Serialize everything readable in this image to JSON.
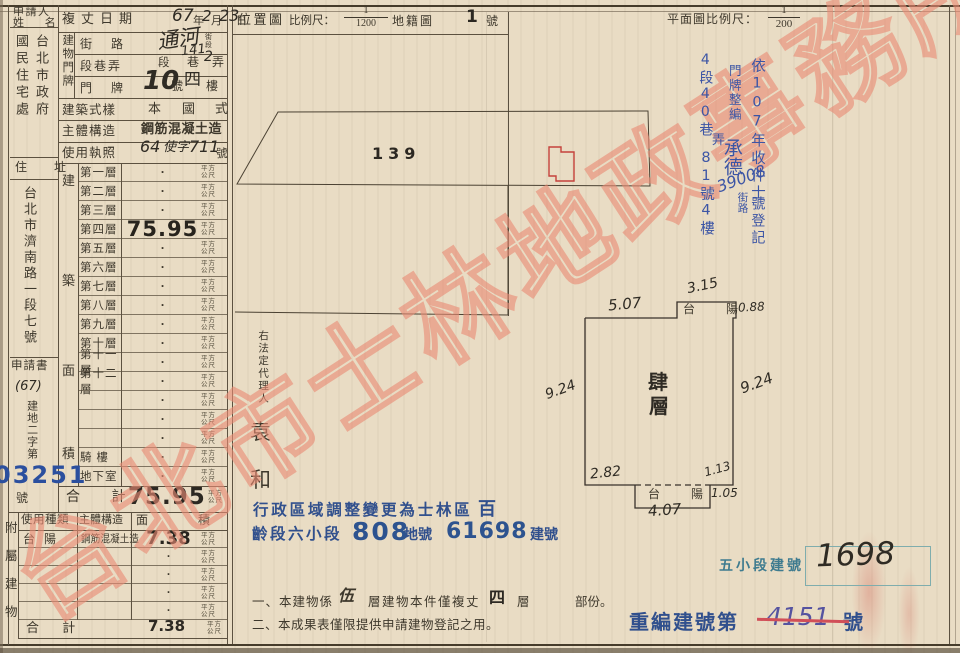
{
  "watermark": {
    "text": "台北市士林地政事務所"
  },
  "header": {
    "survey_label": "複丈日期",
    "survey_y": "67",
    "survey_y_u": "年",
    "survey_m": "2",
    "survey_m_u": "月",
    "survey_d": "23",
    "survey_d_u": "日"
  },
  "applicant": {
    "label1": "申請人",
    "label2": "姓 名",
    "org_right": "台北市政府",
    "org_left": "國民住宅處",
    "addr_label": "住 址",
    "address": "台北市濟南路一段七號",
    "doc_label": "申請書",
    "doc_year": "(67)",
    "doc_chars": "建地二字第",
    "doc_no": "03251",
    "doc_suffix": "號"
  },
  "plate": {
    "label": "建物門牌",
    "street_label": "街 路",
    "street_value": "通河",
    "street_tiny1": "街",
    "street_tiny2": "段",
    "sec_label": "段巷弄",
    "sec_t1": "段",
    "sec_hw1": "141",
    "sec_t2": "巷",
    "sec_hw2": "2",
    "sec_t3": "弄",
    "door_label": "門 牌",
    "door_no": "10",
    "door_t1": "號",
    "door_hw": "四",
    "door_t2": "樓"
  },
  "rows": {
    "style_label": "建築式樣",
    "style_v1": "本",
    "style_v2": "國",
    "style_v3": "式",
    "struct_label": "主體構造",
    "struct_value": "鋼筋混凝土造",
    "lic_label": "使用執照",
    "lic_hw1": "64",
    "lic_hw2": "使字",
    "lic_hw3": "711",
    "lic_suffix": "號"
  },
  "floors": {
    "side": [
      "建",
      "築",
      "面",
      "積"
    ],
    "rows": [
      {
        "name": "第一層",
        "value": "·"
      },
      {
        "name": "第二層",
        "value": "·"
      },
      {
        "name": "第三層",
        "value": "·"
      },
      {
        "name": "第四層",
        "value": "75.95",
        "big": true
      },
      {
        "name": "第五層",
        "value": "·"
      },
      {
        "name": "第六層",
        "value": "·"
      },
      {
        "name": "第七層",
        "value": "·"
      },
      {
        "name": "第八層",
        "value": "·"
      },
      {
        "name": "第九層",
        "value": "·"
      },
      {
        "name": "第十層",
        "value": "·"
      },
      {
        "name": "第十一層",
        "value": "·"
      },
      {
        "name": "第十二層",
        "value": "·"
      },
      {
        "name": "",
        "value": "·"
      },
      {
        "name": "",
        "value": "·"
      },
      {
        "name": "",
        "value": "·"
      },
      {
        "name": "騎 樓",
        "value": "·"
      },
      {
        "name": "地下室",
        "value": "·"
      }
    ],
    "total_label": "合 計",
    "total_value": "75.95"
  },
  "unit": {
    "l1": "平方",
    "l2": "公尺"
  },
  "annex": {
    "side": [
      "附",
      "屬",
      "建",
      "物"
    ],
    "h_use": "使用種類",
    "h_struct": "主體構造",
    "h_area1": "面",
    "h_area2": "積",
    "rows": [
      {
        "use": "台 陽",
        "structure": "鋼筋混凝土造",
        "area": "7.38",
        "big": true
      },
      {
        "use": "",
        "structure": "",
        "area": "·"
      },
      {
        "use": "",
        "structure": "",
        "area": "·"
      },
      {
        "use": "",
        "structure": "",
        "area": "·"
      },
      {
        "use": "",
        "structure": "",
        "area": "·"
      }
    ],
    "total_label": "合 計",
    "total_value": "7.38"
  },
  "locmap": {
    "title": "位置圖",
    "scale": "比例尺：",
    "num": "1",
    "den": "1200",
    "map": "地籍圖",
    "sheet": "1",
    "sheet_u": "號",
    "parcel": "139"
  },
  "plan": {
    "title": "平面圖比例尺：",
    "num": "1",
    "den": "200",
    "room1": "肆",
    "room2": "層",
    "balcony": "台 陽",
    "balcony2": "台 陽",
    "d_top": "5.07",
    "d_btop": "3.15",
    "d_bright": "0.88",
    "d_left": "9.24",
    "d_right": "9.24",
    "d_bl": "2.82",
    "d_br": "1.13",
    "d_step": "1.05",
    "d_bbot": "4.07"
  },
  "bluenotes": {
    "c1a": "依107年收件士",
    "c1b": "39008",
    "c1c": "號登記",
    "c2a": "門牌整編",
    "c2b": "承德",
    "c2c": "街路",
    "c3a": "4段40巷",
    "c3b": "弄",
    "c3c": "81號4樓"
  },
  "agent": {
    "label": "右法定代理人",
    "given1": "袁",
    "given2": "和"
  },
  "adminstamp": {
    "l1": "行政區域調整變更為士林區",
    "l1b": "百",
    "l2a": "齡段六小段",
    "l2b": "808",
    "l2c": "地號",
    "l2d": "61698",
    "l2e": "建號"
  },
  "notes": {
    "n1a": "一、本建物係",
    "n1b": "伍",
    "n1c": "層建物本件僅複丈",
    "n1d": "四",
    "n1e": "層",
    "n1f": "部份。",
    "n2": "二、本成果表僅限提供申請建物登記之用。"
  },
  "renumber": {
    "five_label": "五小段建號",
    "five_value": "1698",
    "re_label": "重編建號第",
    "re_value": "4151",
    "re_suffix": "號"
  }
}
